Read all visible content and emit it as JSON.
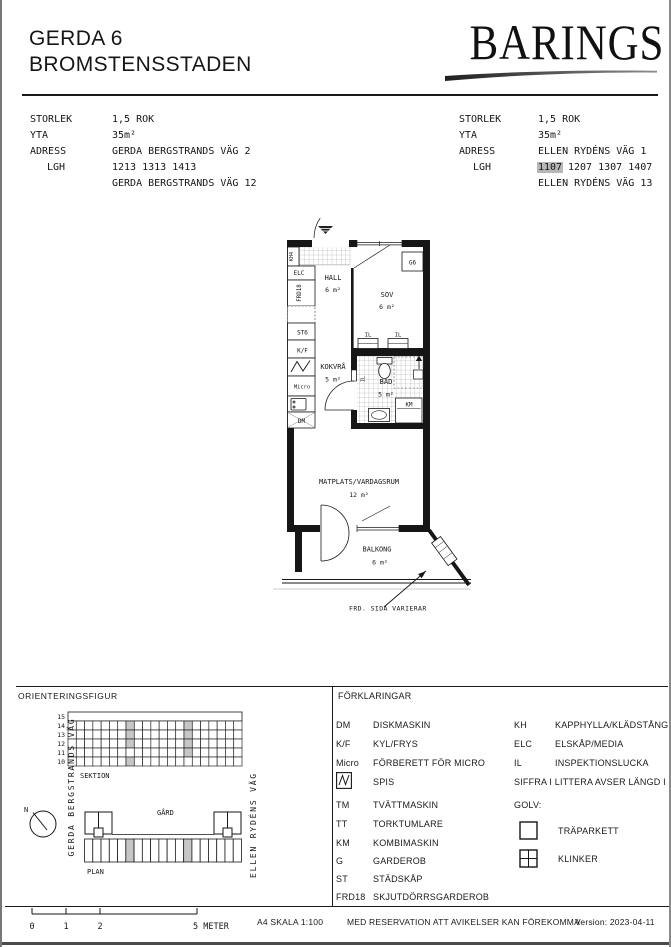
{
  "colors": {
    "paper": "#ffffff",
    "ink": "#1a1a1a",
    "lgh_highlight": "#b7b7b7",
    "grid_highlight": "#c6c6c6"
  },
  "header": {
    "title_line1": "GERDA 6",
    "title_line2": "BROMSTENSSTADEN",
    "brand": "BARINGS"
  },
  "info_left": {
    "storlek_label": "STORLEK",
    "storlek": "1,5 ROK",
    "yta_label": "YTA",
    "yta": "35m²",
    "adress_label": "ADRESS",
    "adress": "GERDA BERGSTRANDS VÄG 2",
    "lgh_label": "LGH",
    "lgh": "1213 1313 1413",
    "adress2": "GERDA BERGSTRANDS VÄG 12"
  },
  "info_right": {
    "storlek_label": "STORLEK",
    "storlek": "1,5 ROK",
    "yta_label": "YTA",
    "yta": "35m²",
    "adress_label": "ADRESS",
    "adress": "ELLEN RYDÉNS VÄG 1",
    "lgh_label": "LGH",
    "lgh_highlight": "1107",
    "lgh_rest": "1207 1307 1407",
    "adress2": "ELLEN RYDÉNS VÄG 13"
  },
  "floorplan": {
    "rooms": {
      "hall": {
        "name": "HALL",
        "area": "6 m²"
      },
      "sov": {
        "name": "SOV",
        "area": "6 m²"
      },
      "kokvra": {
        "name": "KOKVRÅ",
        "area": "5 m²"
      },
      "bad": {
        "name": "BAD",
        "area": "5 m²"
      },
      "matplats": {
        "name": "MATPLATS/VARDAGSRUM",
        "area": "12 m²"
      },
      "balkong": {
        "name": "BALKONG",
        "area": "6 m²"
      }
    },
    "fixtures": {
      "kh4": "KH4",
      "elc": "ELC",
      "frd18": "FRD18",
      "st6": "ST6",
      "kf": "K/F",
      "micro": "Micro",
      "dm": "DM",
      "g6": "G6",
      "km": "KM",
      "il_a": "IL",
      "il_b": "IL",
      "il_c": "IL"
    },
    "annotation": "FRD. SIDA VARIERAR"
  },
  "orientation": {
    "title": "ORIENTERINGSFIGUR",
    "section_label": "SEKTION",
    "plan_label": "PLAN",
    "gard_label": "GÅRD",
    "north_label": "N",
    "street_left": "GERDA BERGSTRANDS VÄG",
    "street_right": "ELLEN RYDÉNS VÄG",
    "section_grid": {
      "floors": [
        "15",
        "14",
        "13",
        "12",
        "11",
        "10"
      ],
      "columns": 21,
      "highlights": [
        {
          "col": 7,
          "floors": [
            "14",
            "13",
            "12",
            "10"
          ]
        },
        {
          "col": 14,
          "floors": [
            "14",
            "13",
            "12",
            "11"
          ]
        }
      ]
    },
    "plan_grid": {
      "columns": 19,
      "highlight_cols": [
        5,
        12
      ]
    }
  },
  "legend": {
    "title": "FÖRKLARINGAR",
    "left": [
      {
        "abbr": "DM",
        "desc": "DISKMASKIN"
      },
      {
        "abbr": "K/F",
        "desc": "KYL/FRYS"
      },
      {
        "abbr": "Micro",
        "desc": "FÖRBERETT FÖR MICRO"
      },
      {
        "abbr": "",
        "desc": "SPIS"
      },
      {
        "abbr": "TM",
        "desc": "TVÄTTMASKIN"
      },
      {
        "abbr": "TT",
        "desc": "TORKTUMLARE"
      },
      {
        "abbr": "KM",
        "desc": "KOMBIMASKIN"
      },
      {
        "abbr": "G",
        "desc": "GARDEROB"
      },
      {
        "abbr": "ST",
        "desc": "STÄDSKÅP"
      },
      {
        "abbr": "FRD18",
        "desc": "SKJUTDÖRRSGARDEROB"
      }
    ],
    "right": [
      {
        "abbr": "KH",
        "desc": "KAPPHYLLA/KLÄDSTÅNG"
      },
      {
        "abbr": "ELC",
        "desc": "ELSKÅP/MEDIA"
      },
      {
        "abbr": "IL",
        "desc": "INSPEKTIONSLUCKA"
      }
    ],
    "note": "SIFFRA I LITTERA AVSER LÄNGD I dm",
    "golv_label": "GOLV:",
    "golv": [
      {
        "desc": "TRÄPARKETT"
      },
      {
        "desc": "KLINKER"
      }
    ]
  },
  "footer": {
    "scale_ticks": [
      "0",
      "1",
      "2"
    ],
    "scale_end": "5 METER",
    "scale_note": "A4 SKALA 1:100",
    "disclaimer": "MED RESERVATION ATT AVIKELSER KAN FÖREKOMMA",
    "version": "Version: 2023-04-11"
  }
}
